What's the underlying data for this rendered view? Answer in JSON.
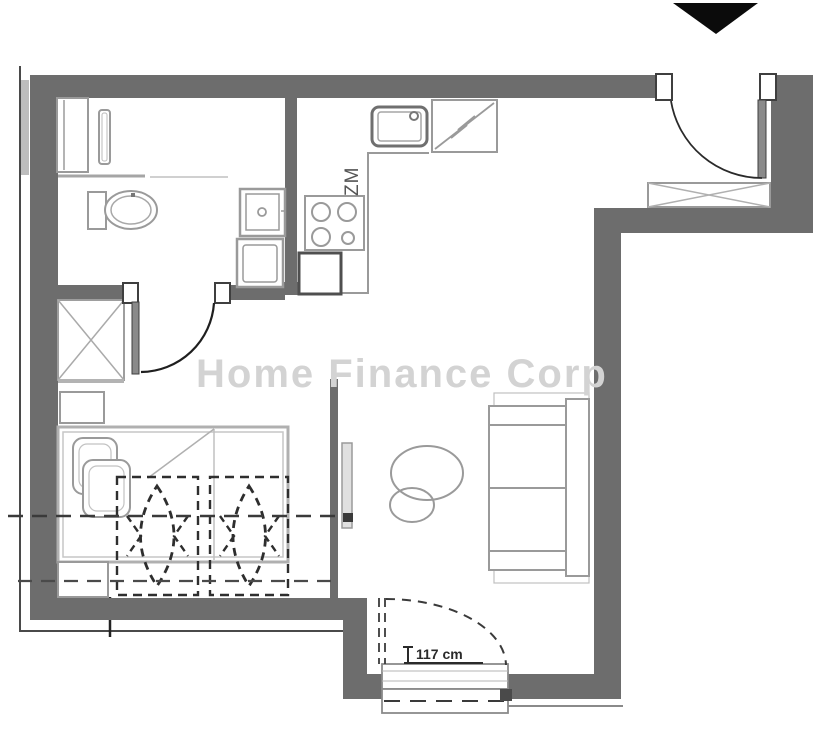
{
  "watermark": {
    "text": "Home Finance Corp"
  },
  "labels": {
    "kitchen_appliance_code": "ZM",
    "balcony_door_width": "117 cm"
  },
  "colors": {
    "wall": "#6d6d6d",
    "furniture_line": "#9a9a9a",
    "light_line": "#c0c0c0",
    "dark_line": "#2e2e2e",
    "watermark": "#d3d3d3",
    "north_marker": "#0b0b0b",
    "background": "#ffffff"
  },
  "elements": {
    "bathroom": [
      "duct-shaft",
      "towel-radiator",
      "toilet",
      "washbasin",
      "washing-machine",
      "bathroom-door"
    ],
    "kitchen": [
      "kitchen-sink",
      "fridge",
      "stove-4-burners",
      "oven",
      "counter"
    ],
    "hall": [
      "entrance-door",
      "entrance-wardrobe",
      "hall-wardrobe-xbox"
    ],
    "bedroom": [
      "bed",
      "pillows",
      "nightstand",
      "overhead-wardrobe-1",
      "overhead-wardrobe-2"
    ],
    "living": [
      "tv-partition",
      "tv",
      "round-tables",
      "sofa",
      "balcony-door"
    ]
  }
}
